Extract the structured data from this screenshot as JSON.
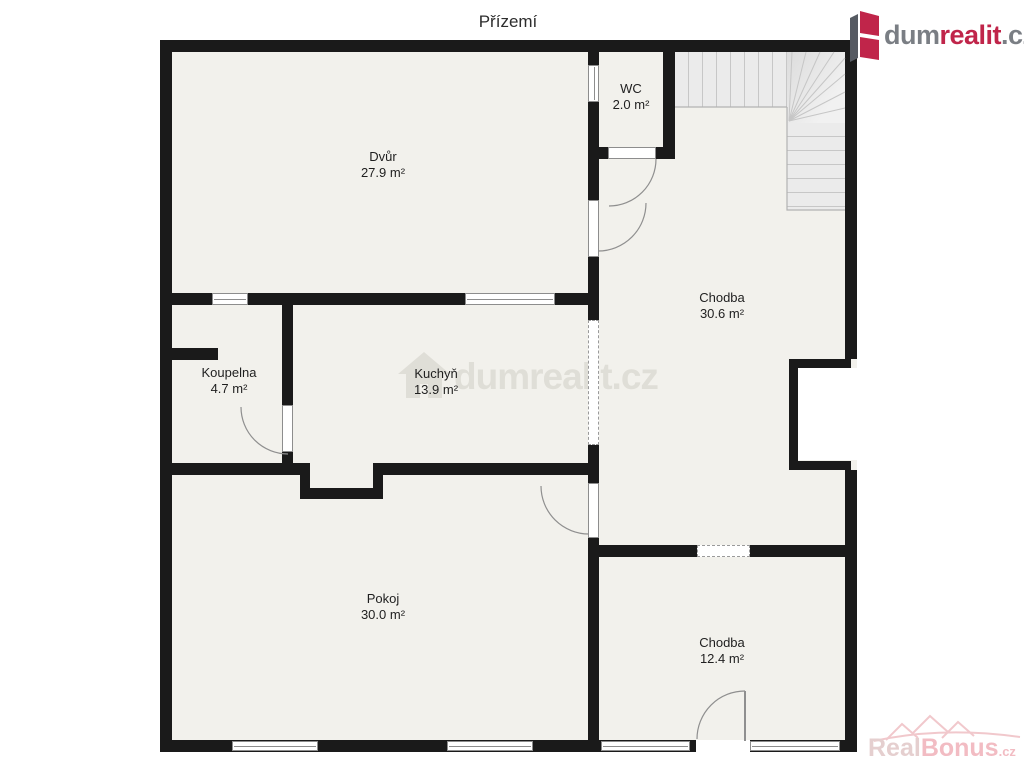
{
  "title": "Přízemí",
  "brand": {
    "logo_dum": "dum",
    "logo_realit": "realit",
    "logo_cz": ".cz"
  },
  "rooms": {
    "dvur": {
      "name": "Dvůr",
      "area": "27.9 m²"
    },
    "wc": {
      "name": "WC",
      "area": "2.0 m²"
    },
    "chodba_upper": {
      "name": "Chodba",
      "area": "30.6 m²"
    },
    "koupelna": {
      "name": "Koupelna",
      "area": "4.7 m²"
    },
    "kuchyn": {
      "name": "Kuchyň",
      "area": "13.9 m²"
    },
    "pokoj": {
      "name": "Pokoj",
      "area": "30.0 m²"
    },
    "chodba_lower": {
      "name": "Chodba",
      "area": "12.4 m²"
    }
  },
  "watermarks": {
    "center": "dumrealit.cz",
    "bottom_real": "Real",
    "bottom_bonus": "Bonus",
    "bottom_cz": ".cz"
  },
  "colors": {
    "wall": "#1a1a1a",
    "floor": "#f2f1ec",
    "logo_red": "#c0254a",
    "logo_gray": "#7a7e84",
    "watermark_gray": "#dedcd5",
    "watermark_pink": "#f2bcc3"
  }
}
